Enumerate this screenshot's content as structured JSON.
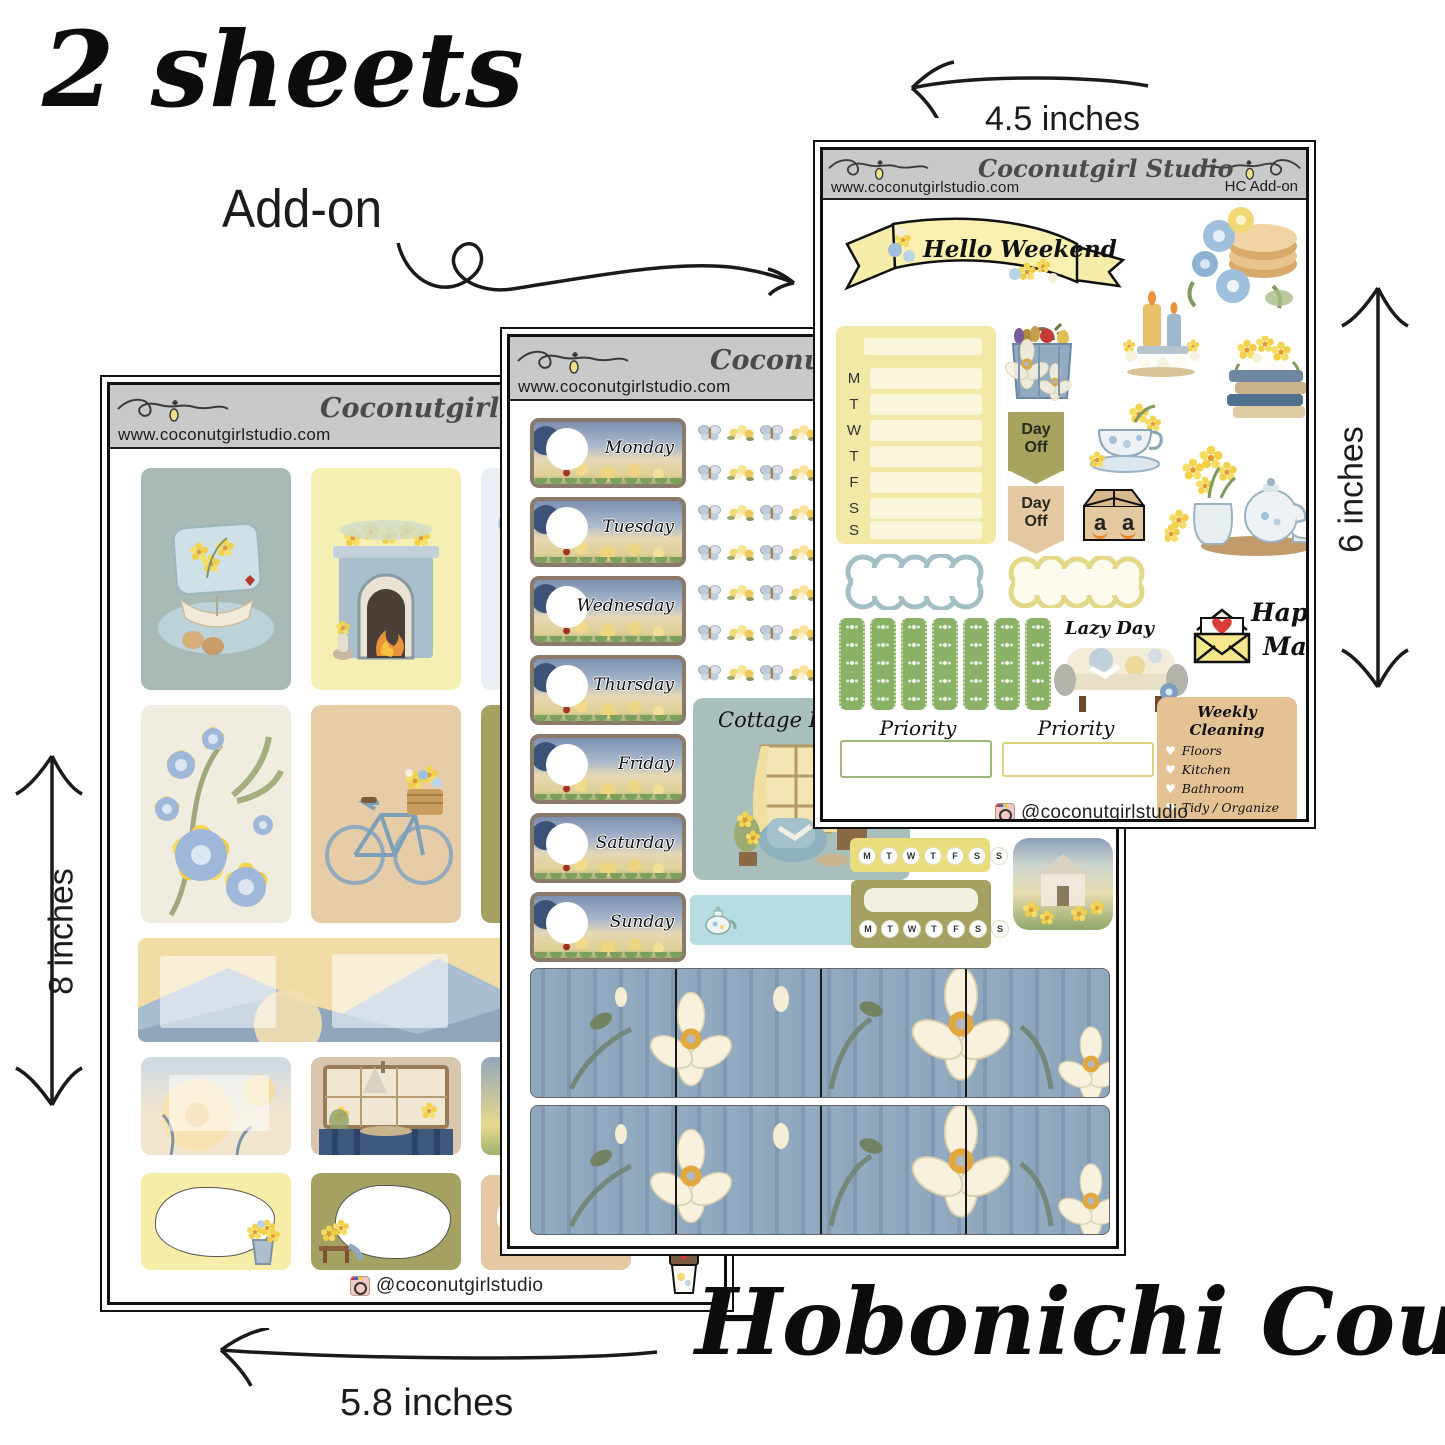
{
  "annotations": {
    "sheet_count_label": "2 sheets",
    "addon_label": "Add-on",
    "dim_top": "4.5 inches",
    "dim_right": "6 inches",
    "dim_left": "8 inches",
    "dim_bottom": "5.8 inches",
    "product_title": "Hobonichi Cousin"
  },
  "brand": {
    "studio_name": "Coconutgirl Studio",
    "website": "www.coconutgirlstudio.com",
    "instagram_handle": "@coconutgirlstudio"
  },
  "weekday_letters": [
    "M",
    "T",
    "W",
    "T",
    "F",
    "S",
    "S"
  ],
  "addon_sheet": {
    "sheet_code": "HC Add-on",
    "banner_text": "Hello Weekend",
    "day_off_tag_1": "Day Off",
    "day_off_tag_2": "Day Off",
    "amazon_letter_1": "a",
    "amazon_letter_2": "a",
    "lazy_day_label": "Lazy Day",
    "happy_mail_line1": "Happy",
    "happy_mail_line2": "Mail",
    "priority_label_1": "Priority",
    "priority_label_2": "Priority",
    "weekly_cleaning": {
      "title": "Weekly Cleaning",
      "items": [
        "Floors",
        "Kitchen",
        "Bathroom",
        "Tidy / Organize",
        "Vacuum/ Sweep"
      ]
    }
  },
  "weekly_sheet": {
    "day_labels": [
      "Monday",
      "Tuesday",
      "Wednesday",
      "Thursday",
      "Friday",
      "Saturday",
      "Sunday"
    ],
    "cottage_escape_label": "Cottage Escape"
  },
  "colors": {
    "header_gray": "#c9c9c9",
    "pale_yellow": "#f2e9a6",
    "olive": "#a4a163",
    "tan": "#e5c9a2",
    "blue_gray": "#a9bab6",
    "light_blue": "#b5dde2",
    "washi_blue": "#8ea7bd",
    "lace_green": "#8bb167",
    "heart_red": "#d93a3a"
  }
}
